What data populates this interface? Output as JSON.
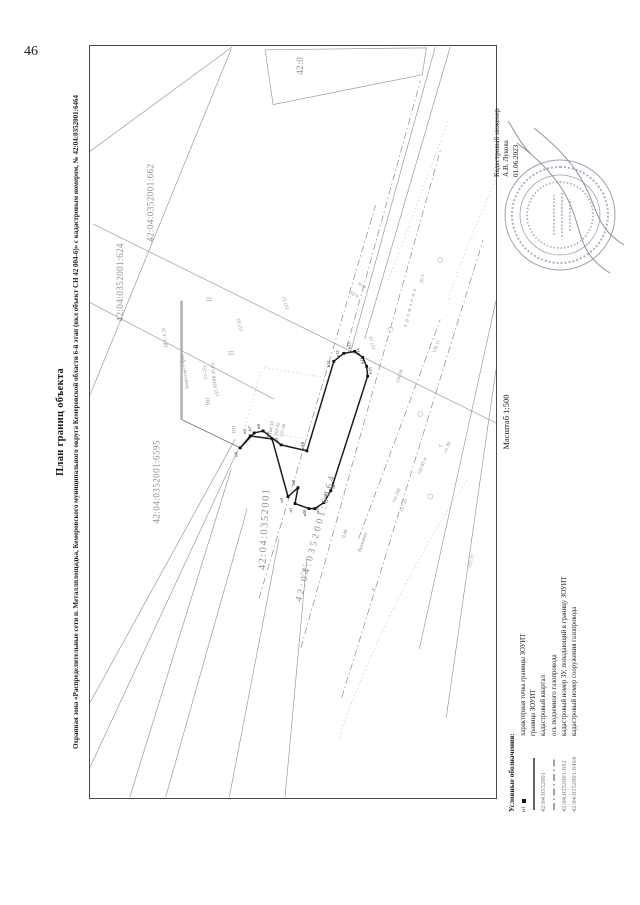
{
  "page_number": "46",
  "title": "План границ объекта",
  "subtitle": "Охранная зона «Распределительные сети п. Металлплощадка, Кемеровского муниципального округа Кемеровской области 6-й этап (вкл объект СН 42 004-6)» с кадастровым номером, № 42:04:0352001:6464",
  "scale_label": "Масштаб 1:500",
  "engineer": {
    "role": "Кадастровый инженер",
    "name": "А.В. Лукова",
    "date": "01.06.2023"
  },
  "legend": {
    "header": "Условные обозначения:",
    "items": [
      {
        "symbol_label": "н1",
        "label": "характерная точка границы ЗОУИТ"
      },
      {
        "symbol_label": "",
        "label": "граница ЗОУИТ"
      },
      {
        "symbol_label": "42:04:0352001",
        "label": "кадастровый квартал"
      },
      {
        "symbol_label": "",
        "label": "ось подземного газопровода"
      },
      {
        "symbol_label": "42:04:0352001:692",
        "label": "кадастровый номер ЗУ, попадающий в границу ЗОУИТ"
      },
      {
        "symbol_label": "42:04:0352001:6464",
        "label": "кадастровый номер сооружения газопровода"
      }
    ]
  },
  "plan": {
    "parcels": {
      "p624": "42:04:0352001:624",
      "p662": "42:04:0352001:662",
      "p6595": "42:04:0352001:6595",
      "cut": "42:0"
    },
    "quarter": "42:04:0352001",
    "zone": "42:04:0352001:6464",
    "points": [
      "н1",
      "н2",
      "н3",
      "н4",
      "н5",
      "н6",
      "н7",
      "н8",
      "н9",
      "н10",
      "н11",
      "н12",
      "н13",
      "н14",
      "н15",
      "н16",
      "н17",
      "н18",
      "н19",
      "н20"
    ],
    "elevations": [
      "157.57",
      "157.63",
      "157.92",
      "157.19",
      "157.26",
      "157.77",
      "156.59",
      "156.11",
      "156.85 м",
      "164.58",
      "163.42",
      "157.60"
    ],
    "notes": [
      "ЦРС-6 25",
      "Закрытая ст-ф25",
      "Ст-25а",
      "ПМ 43.92",
      "промзона",
      "газ 200",
      "ст. 89",
      "2×0.7",
      "0.40",
      "Времянка",
      "6.05",
      "4.10",
      "НП",
      "II",
      "Г",
      "20 3"
    ]
  }
}
